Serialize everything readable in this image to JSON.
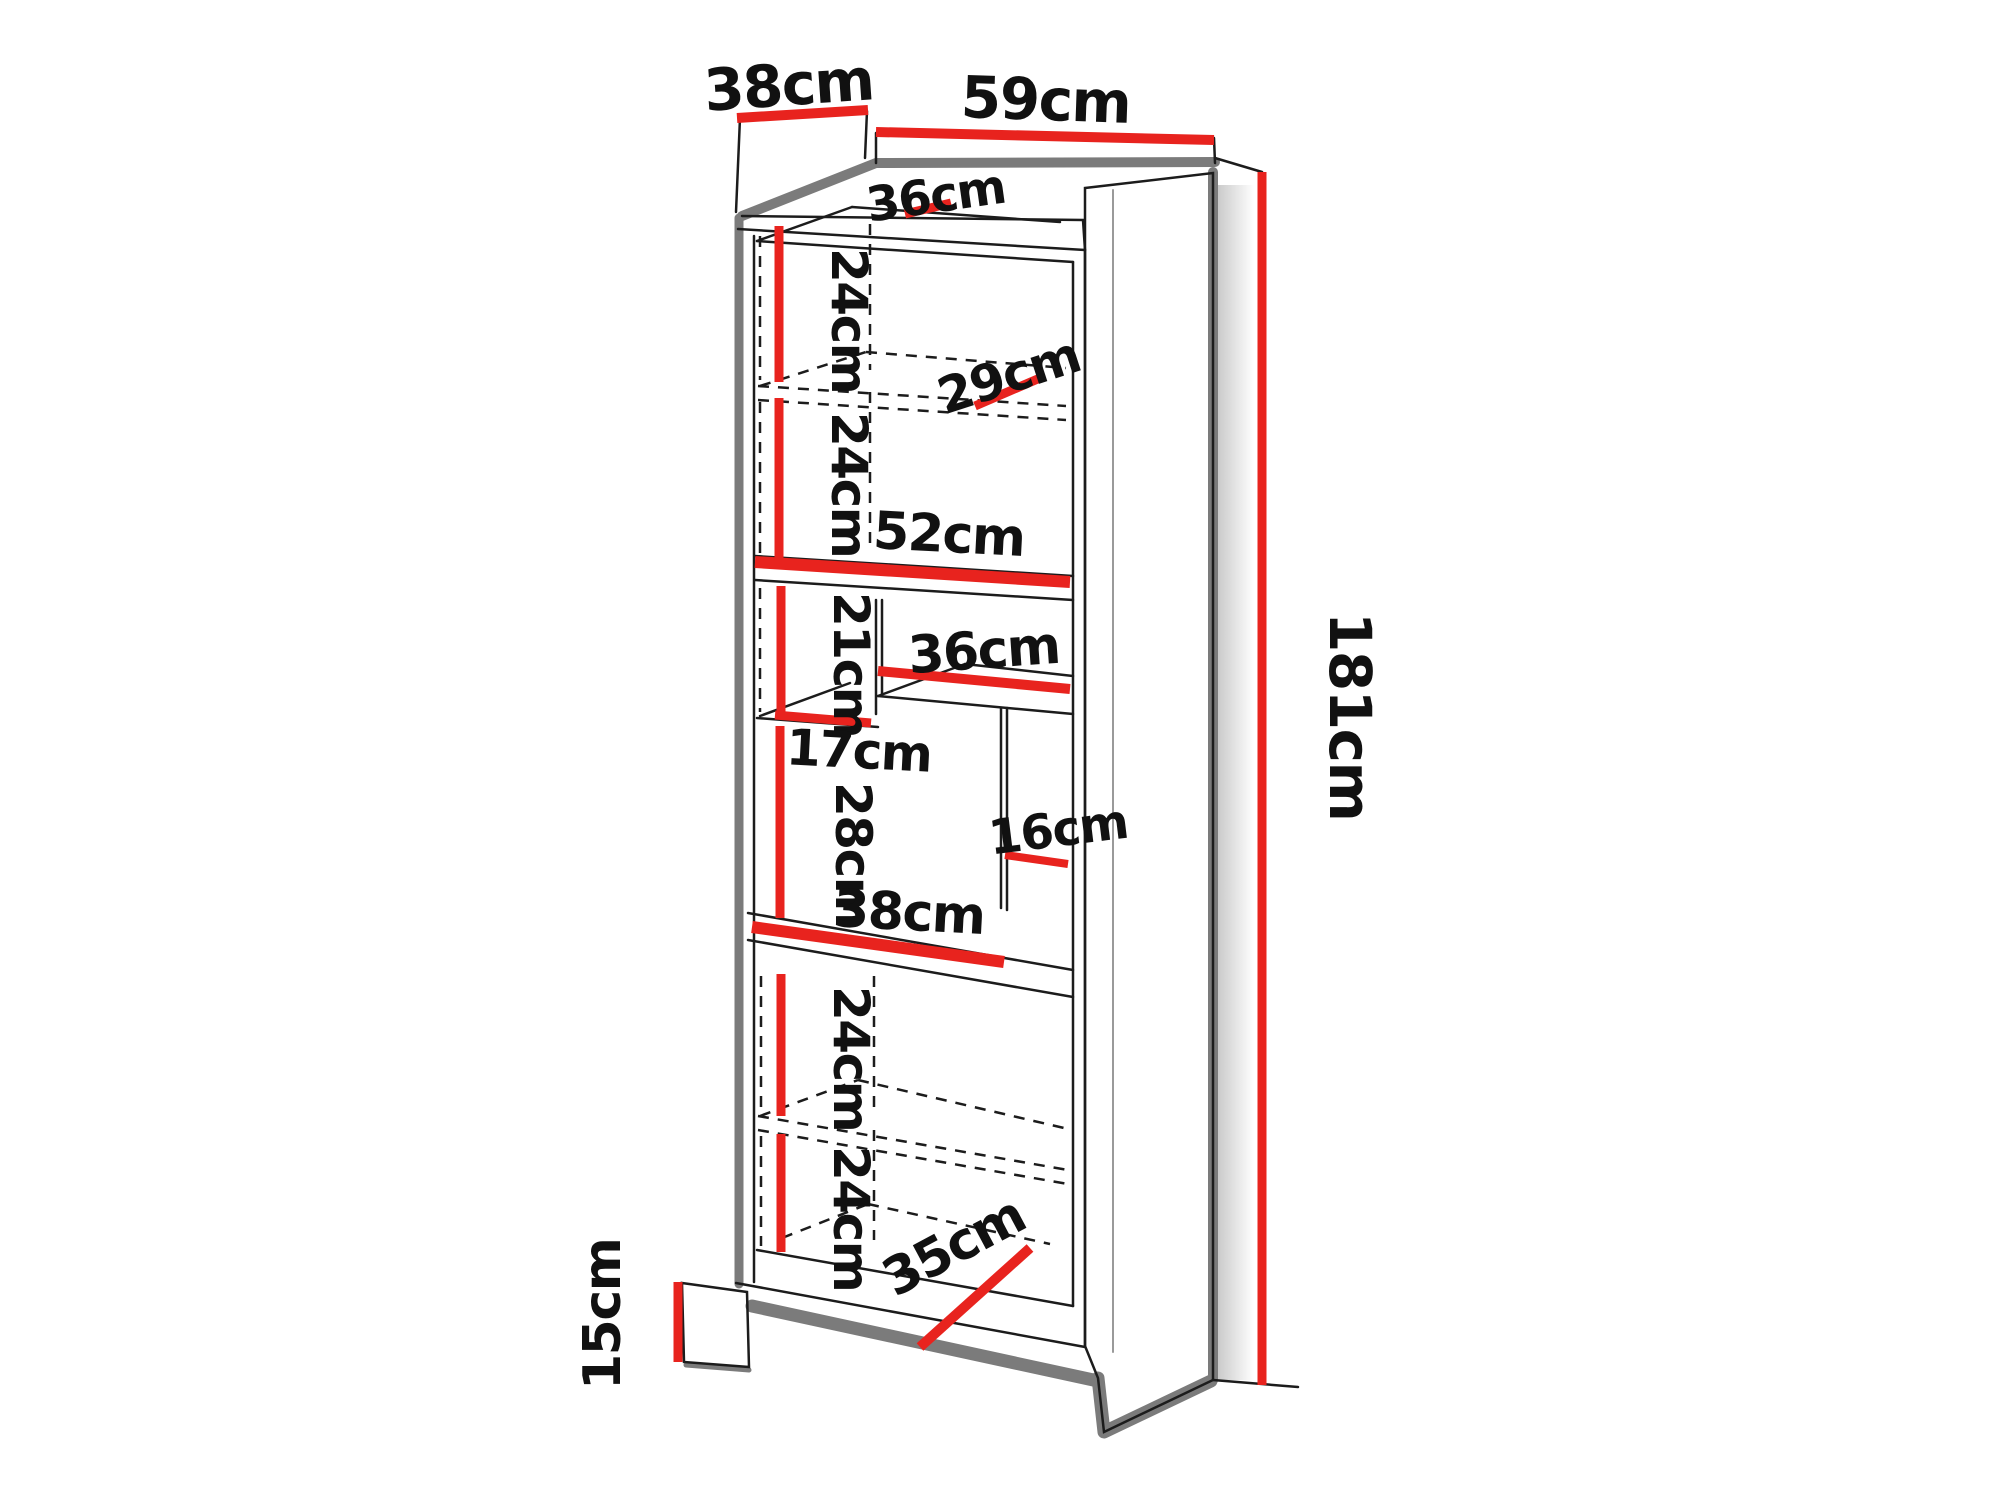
{
  "figure": {
    "type": "furniture-dimension-diagram",
    "subject": "tall bookcase / shelving cabinet, perspective line drawing with red dimension marks"
  },
  "colors": {
    "accent_red": "#e8231e",
    "line": "#1c1c1c",
    "outline_gray": "#7b7b7b",
    "shadow_gray": "#c9c9c9",
    "surface": "#ffffff",
    "text": "#111111"
  },
  "dimensions": {
    "height_cm": 181,
    "width_cm": 59,
    "depth_cm": 38,
    "plinth_height_cm": 15
  },
  "labels": {
    "depth_top": {
      "text": "38cm"
    },
    "width_top": {
      "text": "59cm"
    },
    "inner_depth_top": {
      "text": "36cm"
    },
    "shelf_h_1": {
      "text": "24cm"
    },
    "shelf_w_29": {
      "text": "29cm"
    },
    "shelf_h_2": {
      "text": "24cm"
    },
    "shelf_w_52": {
      "text": "52cm"
    },
    "shelf_h_21": {
      "text": "21cm"
    },
    "cubby_w_36": {
      "text": "36cm"
    },
    "shelf_h_17": {
      "text": "17cm"
    },
    "shelf_h_28": {
      "text": "28cm"
    },
    "cubby_w_16": {
      "text": "16cm"
    },
    "shelf_w_38": {
      "text": "38cm"
    },
    "shelf_h_3": {
      "text": "24cm"
    },
    "shelf_h_4": {
      "text": "24cm"
    },
    "shelf_w_35": {
      "text": "35cm"
    },
    "total_height": {
      "text": "181cm"
    },
    "plinth_height": {
      "text": "15cm"
    }
  }
}
